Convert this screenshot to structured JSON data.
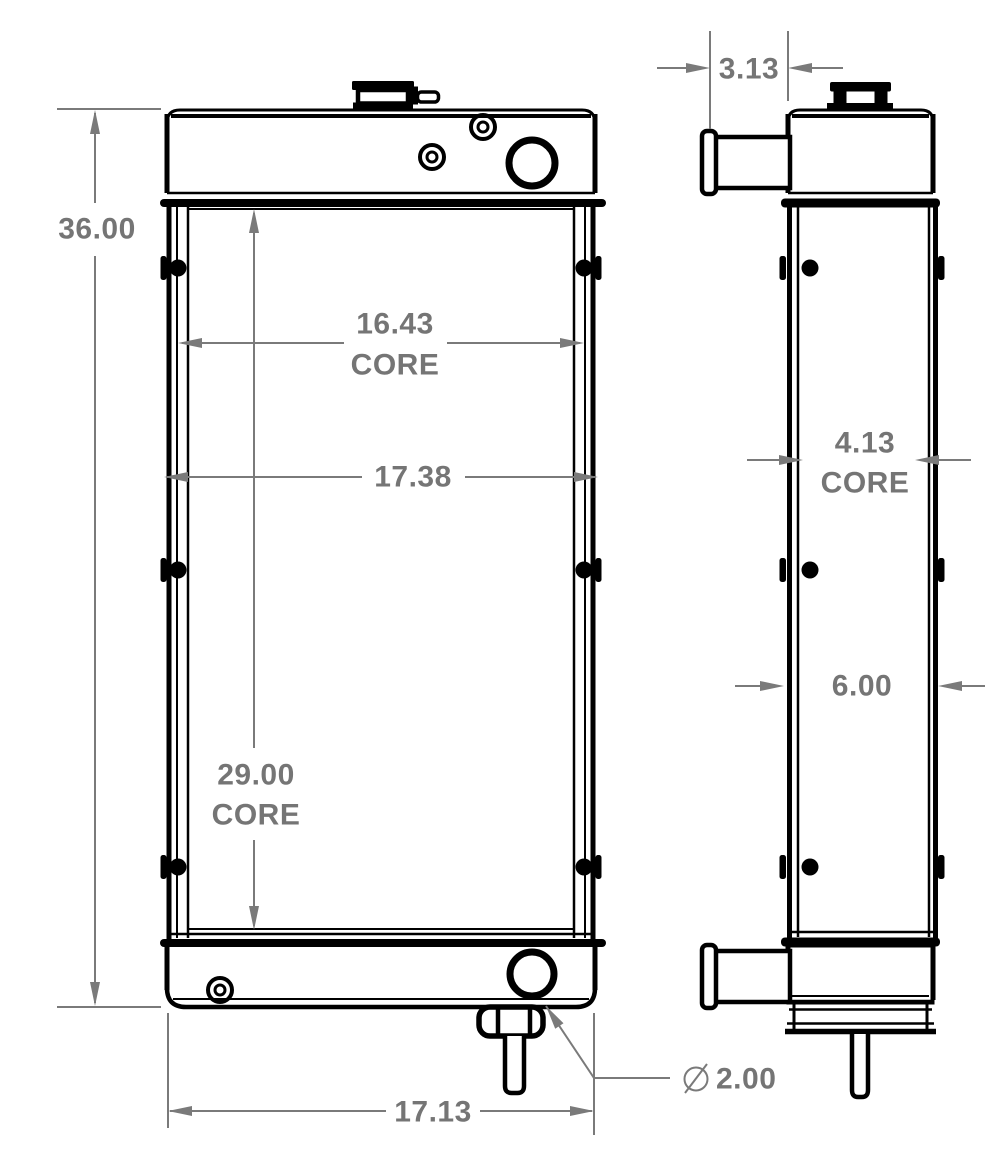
{
  "page": {
    "background": "#ffffff"
  },
  "drawing": {
    "type": "technical-dimension-drawing",
    "subject": "radiator-front-and-side-views",
    "ink_color": "#000000",
    "dim_color": "#7a7a7a",
    "dimensions": {
      "overall_height": "36.00",
      "core_width": "16.43",
      "core_width_label": "CORE",
      "upper_width": "17.38",
      "core_height": "29.00",
      "core_height_label": "CORE",
      "overall_width": "17.13",
      "fitting_protrusion": "3.13",
      "core_depth": "4.13",
      "core_depth_label": "CORE",
      "overall_depth": "6.00",
      "diameter_symbol": "⌀",
      "outlet_diameter": "2.00"
    }
  }
}
